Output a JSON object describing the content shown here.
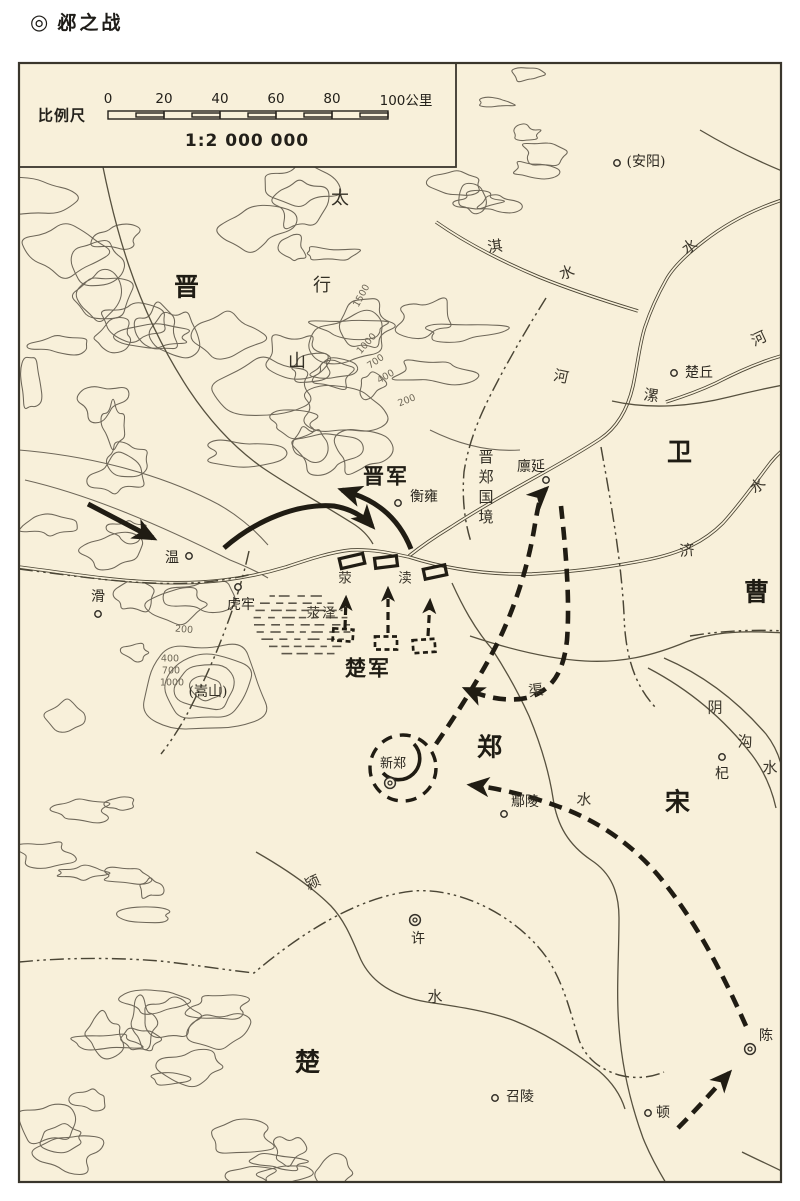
{
  "title": {
    "marker": "◎",
    "text": "邲之战"
  },
  "scale_bar": {
    "label": "比例尺",
    "ratio": "1:2 000 000",
    "ticks": [
      "0",
      "20",
      "40",
      "60",
      "80"
    ],
    "unit_tick": "100公里"
  },
  "colors": {
    "background": "#f8f0da",
    "line": "#45412f",
    "contour": "#6e6759",
    "military": "#201c13"
  },
  "labels": [
    {
      "id": "state-jin",
      "text": "晋",
      "kind": "state",
      "x": 187,
      "y": 287
    },
    {
      "id": "state-wei",
      "text": "卫",
      "kind": "state",
      "x": 680,
      "y": 452
    },
    {
      "id": "state-cao",
      "text": "曹",
      "kind": "state",
      "x": 757,
      "y": 592
    },
    {
      "id": "state-zheng",
      "text": "郑",
      "kind": "state",
      "x": 490,
      "y": 747
    },
    {
      "id": "state-song",
      "text": "宋",
      "kind": "state",
      "x": 678,
      "y": 802
    },
    {
      "id": "state-chu",
      "text": "楚",
      "kind": "state",
      "x": 308,
      "y": 1062
    },
    {
      "id": "army-jin",
      "text": "晋军",
      "kind": "army",
      "x": 386,
      "y": 477
    },
    {
      "id": "army-chu",
      "text": "楚军",
      "kind": "army",
      "x": 368,
      "y": 669
    },
    {
      "id": "mountain-tai",
      "text": "太",
      "kind": "mountain",
      "x": 340,
      "y": 199
    },
    {
      "id": "mountain-xing",
      "text": "行",
      "kind": "mountain",
      "x": 322,
      "y": 286
    },
    {
      "id": "mountain-shan",
      "text": "山",
      "kind": "mountain",
      "x": 297,
      "y": 362
    },
    {
      "id": "mountain-songshan",
      "text": "(嵩山)",
      "kind": "paren",
      "x": 208,
      "y": 692
    },
    {
      "id": "town-anyang",
      "text": "(安阳)",
      "kind": "town",
      "x": 646,
      "y": 162,
      "dot": {
        "x": 617,
        "y": 163,
        "t": "dot"
      }
    },
    {
      "id": "town-chuqiu",
      "text": "楚丘",
      "kind": "town",
      "x": 699,
      "y": 373,
      "dot": {
        "x": 674,
        "y": 373,
        "t": "dot"
      }
    },
    {
      "id": "town-hengyong",
      "text": "衡雍",
      "kind": "town",
      "x": 424,
      "y": 497,
      "dot": {
        "x": 398,
        "y": 503,
        "t": "dot"
      }
    },
    {
      "id": "town-linyan",
      "text": "廪延",
      "kind": "town",
      "x": 531,
      "y": 467,
      "dot": {
        "x": 546,
        "y": 480,
        "t": "dot"
      }
    },
    {
      "id": "town-wen",
      "text": "温",
      "kind": "town",
      "x": 172,
      "y": 558,
      "dot": {
        "x": 189,
        "y": 556,
        "t": "dot"
      }
    },
    {
      "id": "town-hua",
      "text": "滑",
      "kind": "town",
      "x": 98,
      "y": 597,
      "dot": {
        "x": 98,
        "y": 614,
        "t": "dot"
      }
    },
    {
      "id": "town-hulao",
      "text": "虎牢",
      "kind": "town",
      "x": 241,
      "y": 605,
      "dot": {
        "x": 238,
        "y": 587,
        "t": "dot"
      }
    },
    {
      "id": "town-xinzheng",
      "text": "新郑",
      "kind": "town-sm",
      "x": 393,
      "y": 764,
      "dot": {
        "x": 390,
        "y": 783,
        "t": "double"
      }
    },
    {
      "id": "town-yanling",
      "text": "鄢陵",
      "kind": "town",
      "x": 525,
      "y": 802,
      "dot": {
        "x": 504,
        "y": 814,
        "t": "dot"
      }
    },
    {
      "id": "town-qi",
      "text": "杞",
      "kind": "town",
      "x": 722,
      "y": 774,
      "dot": {
        "x": 722,
        "y": 757,
        "t": "dot"
      }
    },
    {
      "id": "town-xu",
      "text": "许",
      "kind": "town",
      "x": 418,
      "y": 939,
      "dot": {
        "x": 415,
        "y": 920,
        "t": "double"
      }
    },
    {
      "id": "town-shaoling",
      "text": "召陵",
      "kind": "town",
      "x": 520,
      "y": 1097,
      "dot": {
        "x": 495,
        "y": 1098,
        "t": "dot"
      }
    },
    {
      "id": "town-dun",
      "text": "顿",
      "kind": "town",
      "x": 663,
      "y": 1113,
      "dot": {
        "x": 648,
        "y": 1113,
        "t": "dot"
      }
    },
    {
      "id": "town-chen",
      "text": "陈",
      "kind": "town",
      "x": 766,
      "y": 1036,
      "dot": {
        "x": 750,
        "y": 1049,
        "t": "double"
      }
    },
    {
      "id": "river-qi",
      "text": "淇",
      "kind": "river",
      "x": 495,
      "y": 247,
      "rot": -8
    },
    {
      "id": "river-qi-shui",
      "text": "水",
      "kind": "river",
      "x": 567,
      "y": 273,
      "rot": -20
    },
    {
      "id": "river-he-shui",
      "text": "水",
      "kind": "river",
      "x": 690,
      "y": 247,
      "rot": -35
    },
    {
      "id": "river-he-east",
      "text": "河",
      "kind": "river",
      "x": 759,
      "y": 339,
      "rot": -25
    },
    {
      "id": "river-he-mid",
      "text": "河",
      "kind": "river",
      "x": 561,
      "y": 377,
      "rot": 12
    },
    {
      "id": "river-luo",
      "text": "漯",
      "kind": "river",
      "x": 651,
      "y": 396,
      "rot": 8
    },
    {
      "id": "river-ji",
      "text": "济",
      "kind": "river",
      "x": 687,
      "y": 551,
      "rot": -5
    },
    {
      "id": "river-ji-shui",
      "text": "水",
      "kind": "river",
      "x": 758,
      "y": 486,
      "rot": -38
    },
    {
      "id": "river-qu",
      "text": "渠",
      "kind": "river",
      "x": 536,
      "y": 691,
      "rot": -8
    },
    {
      "id": "river-qu-shui",
      "text": "水",
      "kind": "river",
      "x": 584,
      "y": 800,
      "rot": 5
    },
    {
      "id": "river-yin",
      "text": "阴",
      "kind": "river",
      "x": 715,
      "y": 708
    },
    {
      "id": "river-gou",
      "text": "沟",
      "kind": "river",
      "x": 745,
      "y": 742
    },
    {
      "id": "river-gou-shui",
      "text": "水",
      "kind": "river",
      "x": 770,
      "y": 768
    },
    {
      "id": "river-ying",
      "text": "颍",
      "kind": "river",
      "x": 313,
      "y": 883,
      "rot": -25
    },
    {
      "id": "river-ying-shui",
      "text": "水",
      "kind": "river",
      "x": 435,
      "y": 997
    },
    {
      "id": "channel-ying",
      "text": "荥",
      "kind": "river-sm",
      "x": 346,
      "y": 579
    },
    {
      "id": "channel-du",
      "text": "渎",
      "kind": "river-sm",
      "x": 406,
      "y": 579
    },
    {
      "id": "marsh-yingze",
      "text": "荥泽",
      "kind": "river-sm",
      "x": 322,
      "y": 614
    },
    {
      "id": "border-jin-zheng",
      "text": "晋郑国境",
      "kind": "vert",
      "x": 485,
      "y": 489
    },
    {
      "id": "elev-1500",
      "text": "1500",
      "kind": "elev",
      "x": 362,
      "y": 296,
      "rot": -62
    },
    {
      "id": "elev-1000",
      "text": "1000",
      "kind": "elev",
      "x": 367,
      "y": 344,
      "rot": -48
    },
    {
      "id": "elev-700",
      "text": "700",
      "kind": "elev",
      "x": 376,
      "y": 362,
      "rot": -35
    },
    {
      "id": "elev-400",
      "text": "400",
      "kind": "elev",
      "x": 386,
      "y": 377,
      "rot": -30
    },
    {
      "id": "elev-200",
      "text": "200",
      "kind": "elev",
      "x": 407,
      "y": 401,
      "rot": -22
    },
    {
      "id": "elev-200b",
      "text": "200",
      "kind": "elev",
      "x": 184,
      "y": 630,
      "rot": 5
    },
    {
      "id": "elev-400b",
      "text": "400",
      "kind": "elev",
      "x": 170,
      "y": 659
    },
    {
      "id": "elev-700b",
      "text": "700",
      "kind": "elev",
      "x": 171,
      "y": 671
    },
    {
      "id": "elev-1000b",
      "text": "1000",
      "kind": "elev",
      "x": 172,
      "y": 683
    }
  ]
}
